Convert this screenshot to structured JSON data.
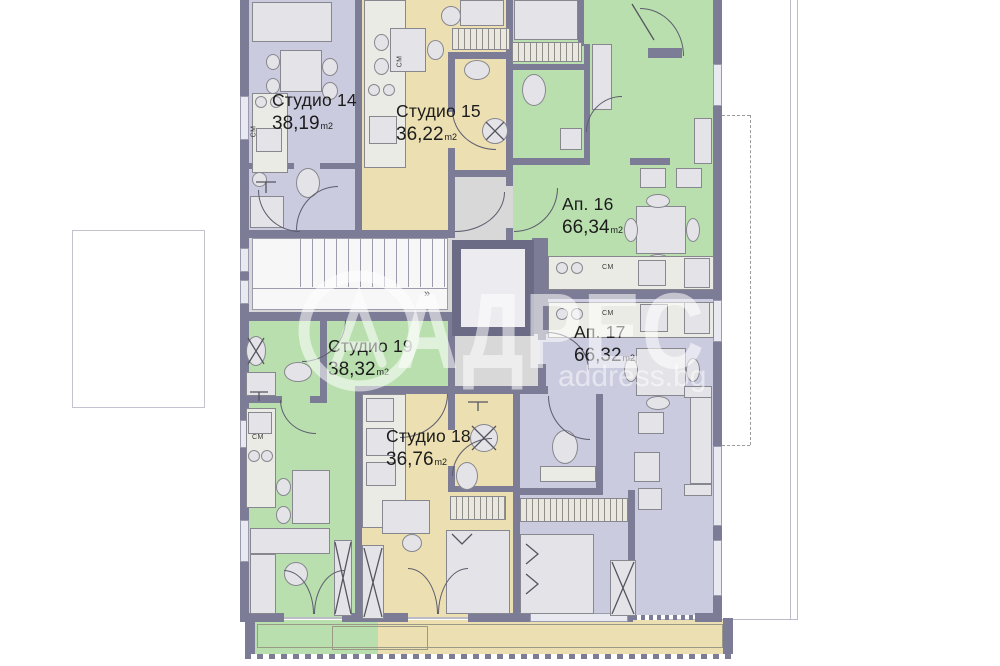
{
  "watermark": {
    "brand": "АДРЕС",
    "site": "address.bg",
    "logo_letter": "А"
  },
  "units": [
    {
      "id": "studio-14",
      "name": "Студио 14",
      "area": "38,19",
      "unit": "m2",
      "color": "#cbcbdf"
    },
    {
      "id": "studio-15",
      "name": "Студио 15",
      "area": "36,22",
      "unit": "m2",
      "color": "#ecdfb2"
    },
    {
      "id": "ap-16",
      "name": "Ап. 16",
      "area": "66,34",
      "unit": "m2",
      "color": "#b9dfae"
    },
    {
      "id": "ap-17",
      "name": "Ап. 17",
      "area": "66,32",
      "unit": "m2",
      "color": "#cbcbdf"
    },
    {
      "id": "studio-18",
      "name": "Студио 18",
      "area": "36,76",
      "unit": "m2",
      "color": "#ecdfb2"
    },
    {
      "id": "studio-19",
      "name": "Студио 19",
      "area": "38,32",
      "unit": "m2",
      "color": "#b9dfae"
    }
  ],
  "annotations": {
    "appliance_label": "СМ",
    "stairs_marker": "»"
  },
  "colors": {
    "wall": "#7c7c96",
    "lavender": "#cbcbdf",
    "tan": "#ecdfb2",
    "green": "#b9dfae",
    "corridor": "#d8d8d8",
    "background": "#ffffff"
  }
}
